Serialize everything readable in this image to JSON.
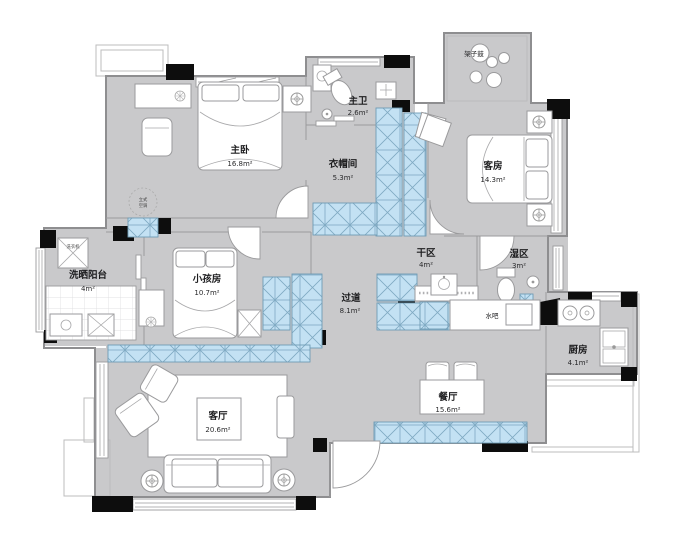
{
  "rooms": {
    "master_bedroom": {
      "name": "主卧",
      "area": "16.8m²"
    },
    "master_bath": {
      "name": "主卫",
      "area": "2.6m²"
    },
    "walk_in_closet": {
      "name": "衣帽间",
      "area": "5.3m²"
    },
    "guest_room": {
      "name": "客房",
      "area": "14.3m²"
    },
    "dry_area": {
      "name": "干区",
      "area": "4m²"
    },
    "wet_area": {
      "name": "湿区",
      "area": "3m²"
    },
    "laundry_balcony": {
      "name": "洗晒阳台",
      "area": "4m²"
    },
    "kids_room": {
      "name": "小孩房",
      "area": "10.7m²"
    },
    "hallway": {
      "name": "过道",
      "area": "8.1m²"
    },
    "living_room": {
      "name": "客厅",
      "area": "20.6m²"
    },
    "dining_room": {
      "name": "餐厅",
      "area": "15.6m²"
    },
    "kitchen": {
      "name": "厨房",
      "area": "4.1m²"
    }
  },
  "labels": {
    "water_bar": "水吧",
    "drum_kit": "架子鼓",
    "washing_machine": "洗衣机",
    "standing_ac_line1": "立式",
    "standing_ac_line2": "空调"
  },
  "colors": {
    "wall_fill": "#c9c9cb",
    "cabinet_fill": "#c3e1f3",
    "column_fill": "#0d0d0d",
    "floor": "#ffffff"
  }
}
